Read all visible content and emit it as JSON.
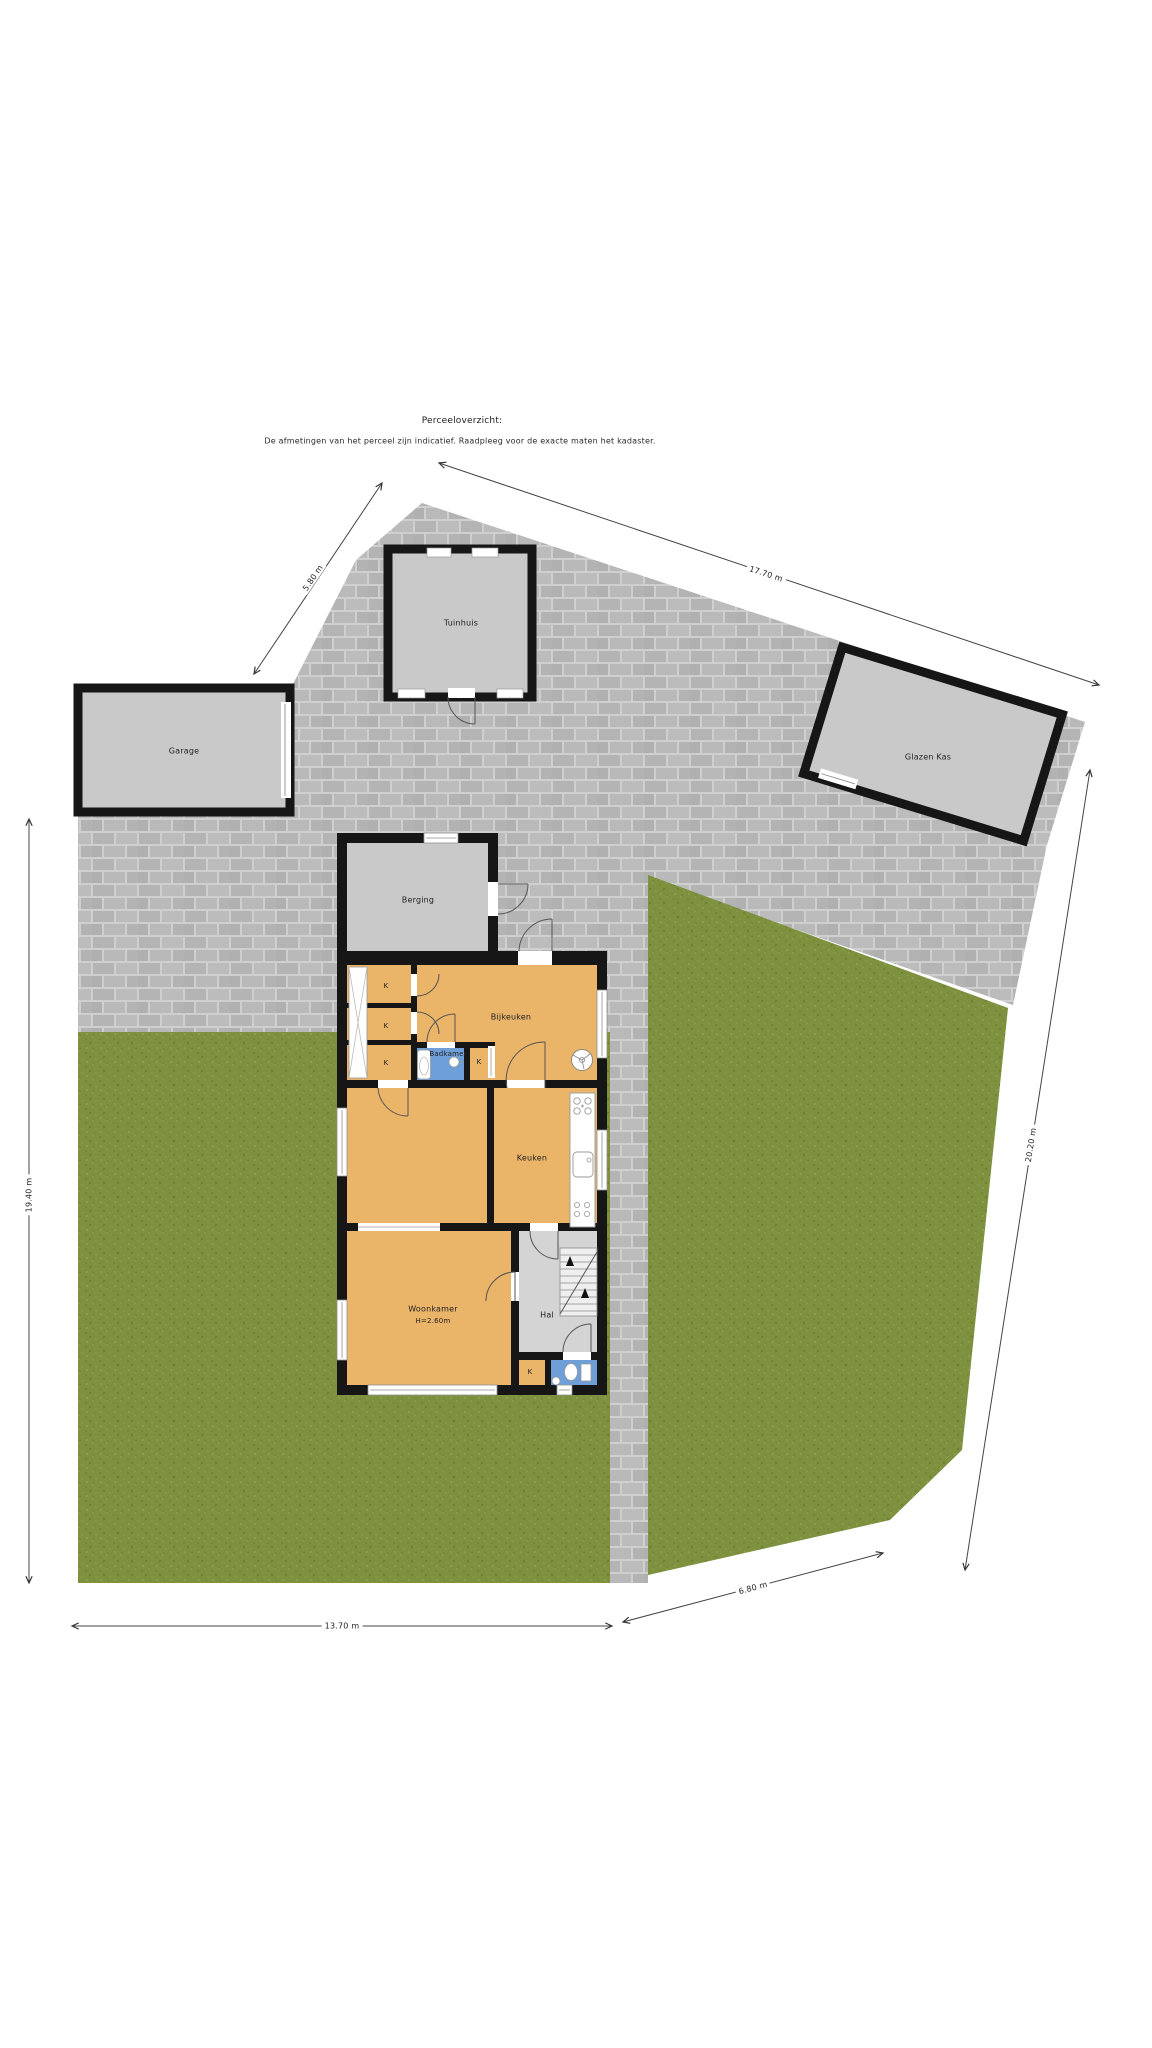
{
  "header": {
    "title": "Perceeloverzicht:",
    "subtitle": "De afmetingen van het perceel zijn indicatief. Raadpleeg voor de exacte maten het kadaster."
  },
  "buildings": {
    "garage": "Garage",
    "tuinhuis": "Tuinhuis",
    "glazen_kas": "Glazen Kas",
    "berging": "Berging"
  },
  "rooms": {
    "bijkeuken": "Bijkeuken",
    "badkamer": "Badkamer",
    "keuken": "Keuken",
    "woonkamer": "Woonkamer",
    "woonkamer_height": "H=2.60m",
    "hal": "Hal",
    "closet": "K"
  },
  "dimensions": {
    "left": "19.40 m",
    "top_left": "5.80 m",
    "top_right": "17.70 m",
    "right": "20.20 m",
    "bottom": "13.70 m",
    "bottom_right": "6.80 m"
  },
  "colors": {
    "paving": "#b6b6b6",
    "paving_joint": "#cfcfcf",
    "grass": "#7d913f",
    "building_fill": "#c9c9c9",
    "floor_orange": "#eab469",
    "wet_room_blue": "#6f9fd8",
    "hall_gray": "#d4d4d4",
    "wall": "#161616"
  }
}
